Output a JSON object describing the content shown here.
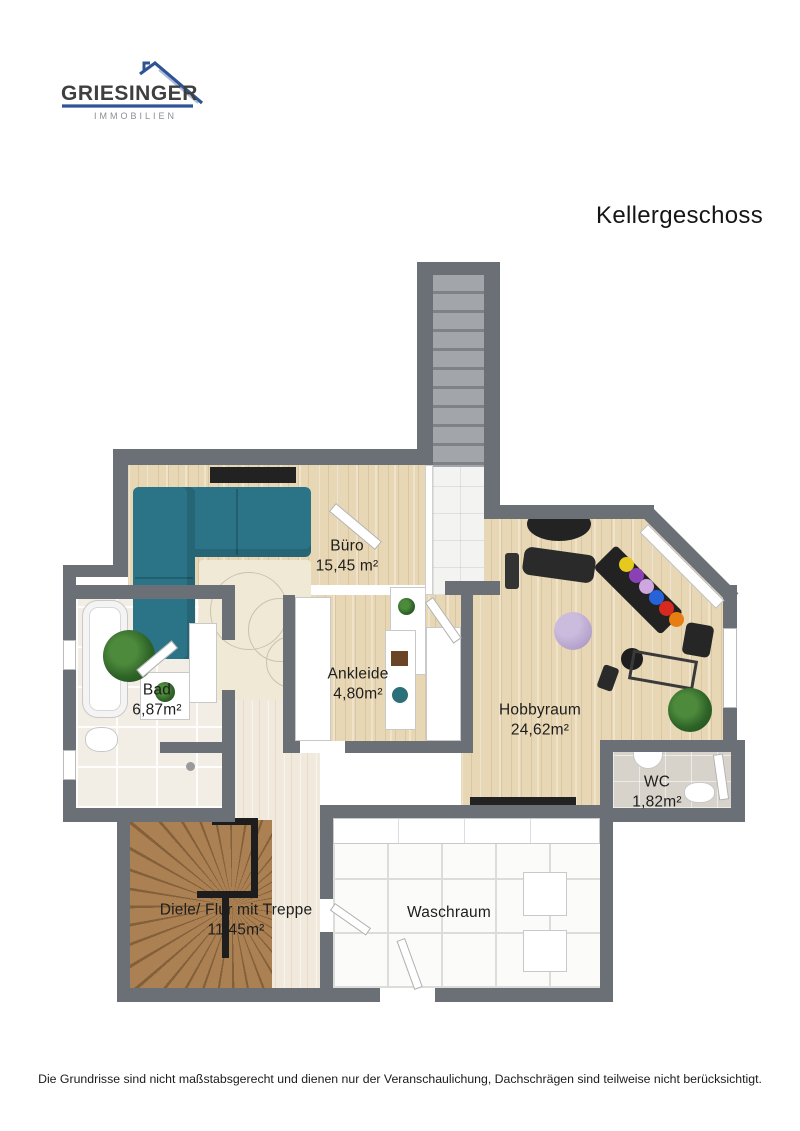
{
  "logo": {
    "name": "GRIESINGER",
    "subtitle": "IMMOBILIEN"
  },
  "header": {
    "title": "Kellergeschoss"
  },
  "rooms": [
    {
      "id": "buero",
      "label": "Büro",
      "area": "15,45 m²"
    },
    {
      "id": "ankleide",
      "label": "Ankleide",
      "area": "4,80m²"
    },
    {
      "id": "bad",
      "label": "Bad",
      "area": "6,87m²"
    },
    {
      "id": "hobbyraum",
      "label": "Hobbyraum",
      "area": "24,62m²"
    },
    {
      "id": "wc",
      "label": "WC",
      "area": "1,82m²"
    },
    {
      "id": "diele",
      "label": "Diele/ Flur mit Treppe",
      "area": "11,45m²"
    },
    {
      "id": "waschraum",
      "label": "Waschraum",
      "area": ""
    }
  ],
  "footer": {
    "disclaimer": "Die Grundrisse sind nicht maßstabsgerecht und dienen nur der Veranschaulichung, Dachschrägen sind teilweise nicht berücksichtigt."
  },
  "colors": {
    "wall": "#6A7076",
    "logo_blue": "#2F5496",
    "logo_text": "#3F3F3F",
    "logo_sub": "#8A8F94",
    "wood": "#E8D7B4",
    "wood_light": "#F0E9DC",
    "tile_bad": "#F2EEE5",
    "tile_wasch": "#FBFBF9",
    "tile_wc": "#D7D3CA",
    "stair_gray": "#9FA3A7",
    "stair_wood": "#A87C4E",
    "sofa_teal": "#2B7386",
    "exercise_ball": "#B6A3CD"
  }
}
